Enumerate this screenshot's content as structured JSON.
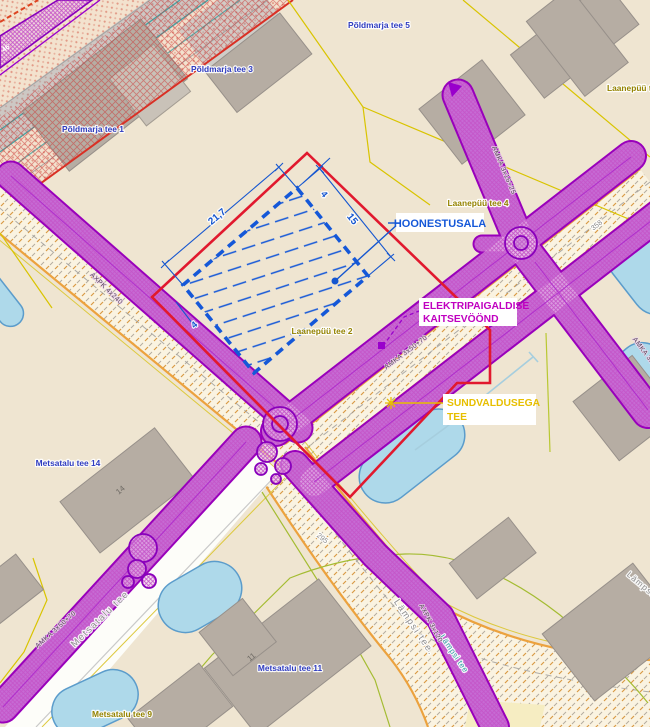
{
  "callouts": {
    "hoonestusala": "HOONESTUSALA",
    "kaitsevoond_line1": "ELEKTRIPAIGALDISE",
    "kaitsevoond_line2": "KAITSEVÖÖND",
    "sundvaldus_line1": "SUNDVALDUSEGA",
    "sundvaldus_line2": "TEE"
  },
  "addresses": {
    "poldmarja5": "Põldmarja tee 5",
    "poldmarja3": "Põldmarja tee 3",
    "poldmarja1": "Põldmarja tee 1",
    "laanepuu4": "Laanepüü tee 4",
    "laanepuu_edge": "Laanepüü tee",
    "laanepuu2": "Laanepüü tee 2",
    "metsatalu14": "Metsatalu tee 14",
    "metsatalu11": "Metsatalu tee 11",
    "metsatalu9": "Metsatalu tee 9"
  },
  "roads": {
    "metsatalu": "Metsatalu tee",
    "lampsi_main": "Lämpsi tee.",
    "lampsi_edge": "Lämpsi tee",
    "lampsi_teal": "Lämpsi tee",
    "num_358": "358",
    "num_295": "295"
  },
  "cables": {
    "axpk4240": "AXPK 4x240",
    "amka5070_left": "AMKA 3x50+70",
    "amka5070_mid": "AMKA 3x50+70",
    "amka1625": "AMKA 3x16+25",
    "amka_edge": "AMKA 3x16+25",
    "axpk3120": "AXPK 3x120",
    "pole_band": "46"
  },
  "dimensions": {
    "long_side": "21,7",
    "short_side": "15",
    "offset_top": "4",
    "offset_bottom": "4"
  },
  "building_numbers": {
    "b14": "14",
    "b11": "11"
  },
  "colors": {
    "boundary_red": "#e1192e",
    "hoonestus_blue": "#1558d8",
    "kaitsevoond_magenta": "#c000c0",
    "sundvaldus_yellow": "#e7bf00",
    "corridor_purple": "#9900cc",
    "road_orange": "#eca23e",
    "water_blue": "#aed9ea",
    "background_beige": "#efe5d1"
  }
}
